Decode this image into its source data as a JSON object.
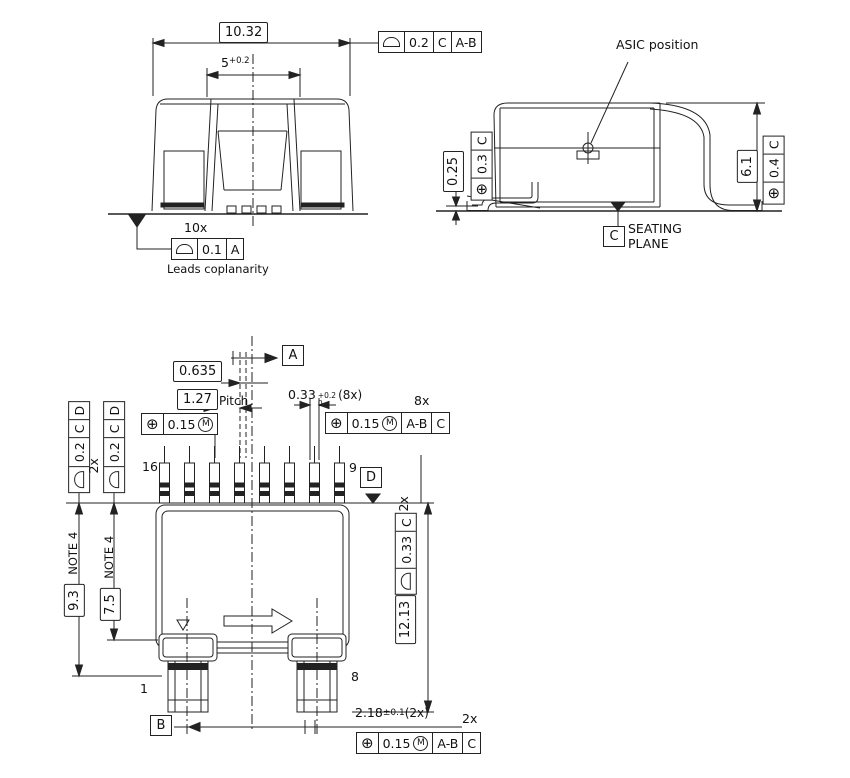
{
  "icons": {
    "position": "⊕",
    "mmc_letter": "M",
    "profile_of_surface": "semicircle-shape",
    "datum_triangle": "filled-triangle"
  },
  "front_view": {
    "dim_overall_width": "10.32",
    "dim_inner_width": "5",
    "dim_inner_width_tol": "+0.2",
    "fcf_top": {
      "tol": "0.2",
      "datum_1": "C",
      "datum_2": "A-B"
    },
    "leads_count": "10x",
    "fcf_leads": {
      "tol": "0.1",
      "datum_1": "A"
    },
    "leads_note": "Leads coplanarity"
  },
  "side_view": {
    "asic_label": "ASIC position",
    "dim_standoff": "0.25",
    "fcf_standoff": {
      "tol": "0.3",
      "datum_1": "C"
    },
    "dim_height": "6.1",
    "fcf_height": {
      "tol": "0.4",
      "datum_1": "C"
    },
    "datum_c": "C",
    "seating_line1": "SEATING",
    "seating_line2": "PLANE"
  },
  "bottom_view": {
    "datum_a": "A",
    "datum_b": "B",
    "datum_d": "D",
    "dim_center_offset": "0.635",
    "dim_pitch": "1.27",
    "pitch_label": "Pitch",
    "fcf_pitch": {
      "tol": "0.15"
    },
    "dim_lead_width": "0.33",
    "dim_lead_width_tol_up": "+0.2",
    "dim_lead_width_tol_dn": "0",
    "dim_lead_width_qty": "(8x)",
    "fcf_leads_qty": "8x",
    "fcf_leads": {
      "tol": "0.15",
      "datum_1": "A-B",
      "datum_2": "C"
    },
    "fcf_sides_qty": "2x",
    "fcf_side": {
      "tol": "0.2",
      "datum_1": "C",
      "datum_2": "D"
    },
    "dim_body_len": "9.3",
    "dim_body_len_note": "NOTE 4",
    "dim_inner_len": "7.5",
    "dim_inner_len_note": "NOTE 4",
    "fcf_edge_qty": "2x",
    "fcf_edge": {
      "tol": "0.33",
      "datum_1": "C"
    },
    "dim_overall_len": "12.13",
    "dim_tab": "2.18",
    "dim_tab_tol": "±0.1",
    "dim_tab_qty": "(2x)",
    "fcf_tabs_qty": "2x",
    "fcf_tabs": {
      "tol": "0.15",
      "datum_1": "A-B",
      "datum_2": "C"
    },
    "pin_first_top": "16",
    "pin_last_top": "9",
    "pin_first_bottom": "1",
    "pin_last_bottom": "8"
  }
}
